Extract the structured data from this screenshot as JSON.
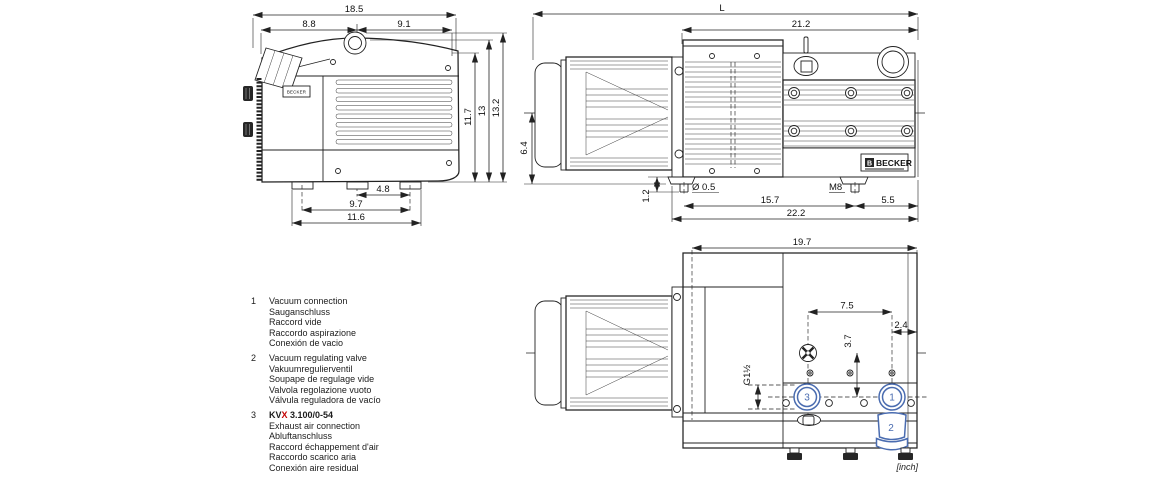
{
  "colors": {
    "line": "#222222",
    "callout_blue": "#4a6cb0",
    "highlight_red": "#c40000"
  },
  "brand": {
    "name": "BECKER",
    "initial": "B",
    "small_plate": "BECKER"
  },
  "unit_note": "[inch]",
  "front_view": {
    "dims": {
      "total_width": "18.5",
      "left_width": "8.8",
      "right_width": "9.1",
      "height_inner": "11.7",
      "height_mid": "13",
      "height_total": "13.2",
      "feet_center": "4.8",
      "feet_inner": "9.7",
      "feet_outer": "11.6"
    }
  },
  "side_view": {
    "dims": {
      "total_length": "L",
      "body_length": "21.2",
      "axis_height": "6.4",
      "foot_height": "1.2",
      "stud_diameter": "Ø 0.5",
      "stud_spacing": "15.7",
      "stud_thread": "M8",
      "rear_overhang": "5.5",
      "overall_feet": "22.2"
    }
  },
  "top_view": {
    "dims": {
      "body_length": "19.7",
      "port_spacing": "7.5",
      "edge_offset": "2.4",
      "valve_offset": "3.7",
      "port_thread": "G1½"
    },
    "callouts": {
      "vacuum_connection": "1",
      "regulating_valve": "2",
      "exhaust_connection": "3"
    }
  },
  "legend": {
    "items": [
      {
        "num": "1",
        "lines": [
          "Vacuum connection",
          "Sauganschluss",
          "Raccord vide",
          "Raccordo aspirazione",
          "Conexión de vacio"
        ]
      },
      {
        "num": "2",
        "lines": [
          "Vacuum regulating valve",
          "Vakuumregulierventil",
          "Soupape de regulage vide",
          "Valvola regolazione vuoto",
          "Válvula reguladora de vacío"
        ]
      },
      {
        "num": "3",
        "model": {
          "prefix": "KV",
          "highlight": "X",
          "suffix": " 3.100/0-54"
        },
        "lines": [
          "Exhaust air connection",
          "Abluftanschluss",
          "Raccord échappement d'air",
          "Raccordo scarico aria",
          "Conexión aire residual"
        ]
      }
    ]
  }
}
